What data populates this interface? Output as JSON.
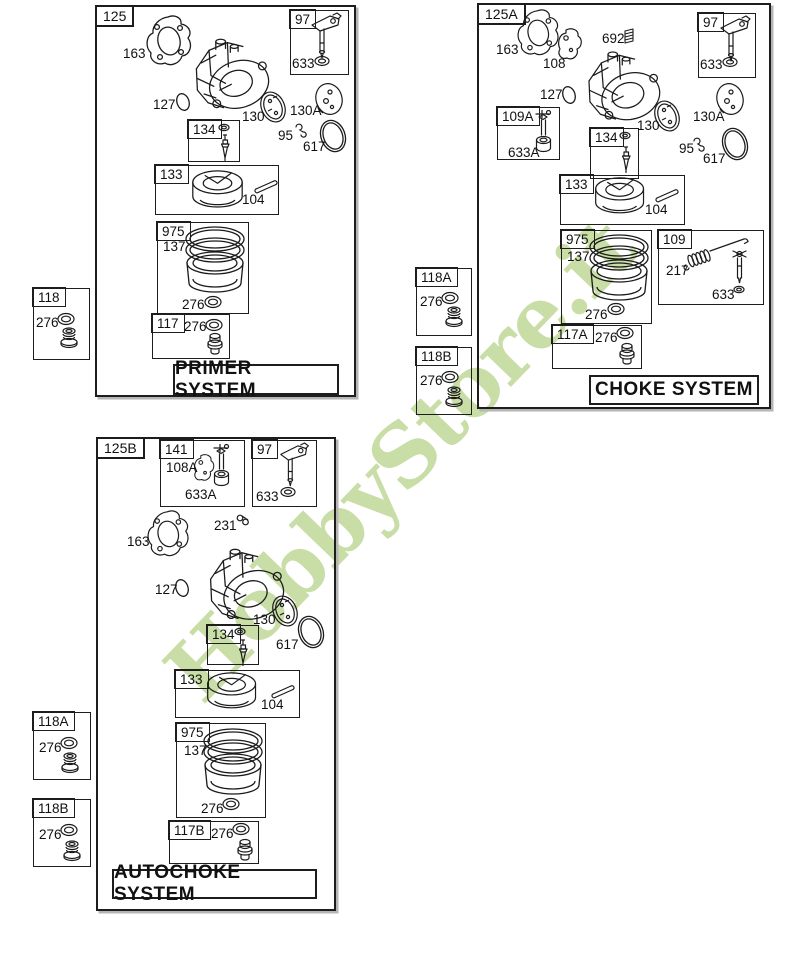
{
  "watermark": {
    "text": "HobbyStore.it",
    "color": "#c7dca3"
  },
  "primer": {
    "box_id": "125",
    "title": "PRIMER SYSTEM",
    "parts": {
      "gasket": "163",
      "oring_inlet": "127",
      "throttle_plate": "130",
      "spacer_disc": "130A",
      "clip": "95",
      "oring_large": "617",
      "throttle_group": "97",
      "throttle_seal": "633",
      "needle_group": "134",
      "float_group": "133",
      "float_pin": "104",
      "bowl_group": "975",
      "bowl_ring": "137",
      "bowl_oring": "276",
      "nut_group": "117",
      "nut_oring": "276",
      "bulb_group": "118",
      "bulb_oring": "276"
    }
  },
  "choke": {
    "box_id": "125A",
    "title": "CHOKE SYSTEM",
    "parts": {
      "gasket": "163",
      "choke_plate": "108",
      "spring_small": "692",
      "oring_inlet": "127",
      "choke_shaft_group": "109A",
      "choke_shaft_seal": "633A",
      "needle_group": "134",
      "throttle_plate": "130",
      "spacer_disc": "130A",
      "clip": "95",
      "oring_large": "617",
      "throttle_group": "97",
      "throttle_seal": "633",
      "float_group": "133",
      "float_pin": "104",
      "bowl_group": "975",
      "bowl_ring": "137",
      "bowl_oring": "276",
      "spring_group": "109",
      "spring_link": "217",
      "spring_shaft_seal": "633",
      "nut_group": "117A",
      "nut_oring": "276",
      "bulb_group_a": "118A",
      "bulb_a_oring": "276",
      "bulb_group_b": "118B",
      "bulb_b_oring": "276"
    }
  },
  "autochoke": {
    "box_id": "125B",
    "title": "AUTOCHOKE SYSTEM",
    "parts": {
      "choke_group": "141",
      "choke_plate": "108A",
      "choke_shaft_seal": "633A",
      "throttle_group": "97",
      "throttle_seal": "633",
      "clip": "231",
      "gasket": "163",
      "oring_inlet": "127",
      "throttle_plate": "130",
      "oring_large": "617",
      "needle_group": "134",
      "float_group": "133",
      "float_pin": "104",
      "bowl_group": "975",
      "bowl_ring": "137",
      "bowl_oring": "276",
      "nut_group": "117B",
      "nut_oring": "276",
      "bulb_group_a": "118A",
      "bulb_a_oring": "276",
      "bulb_group_b": "118B",
      "bulb_b_oring": "276"
    }
  }
}
